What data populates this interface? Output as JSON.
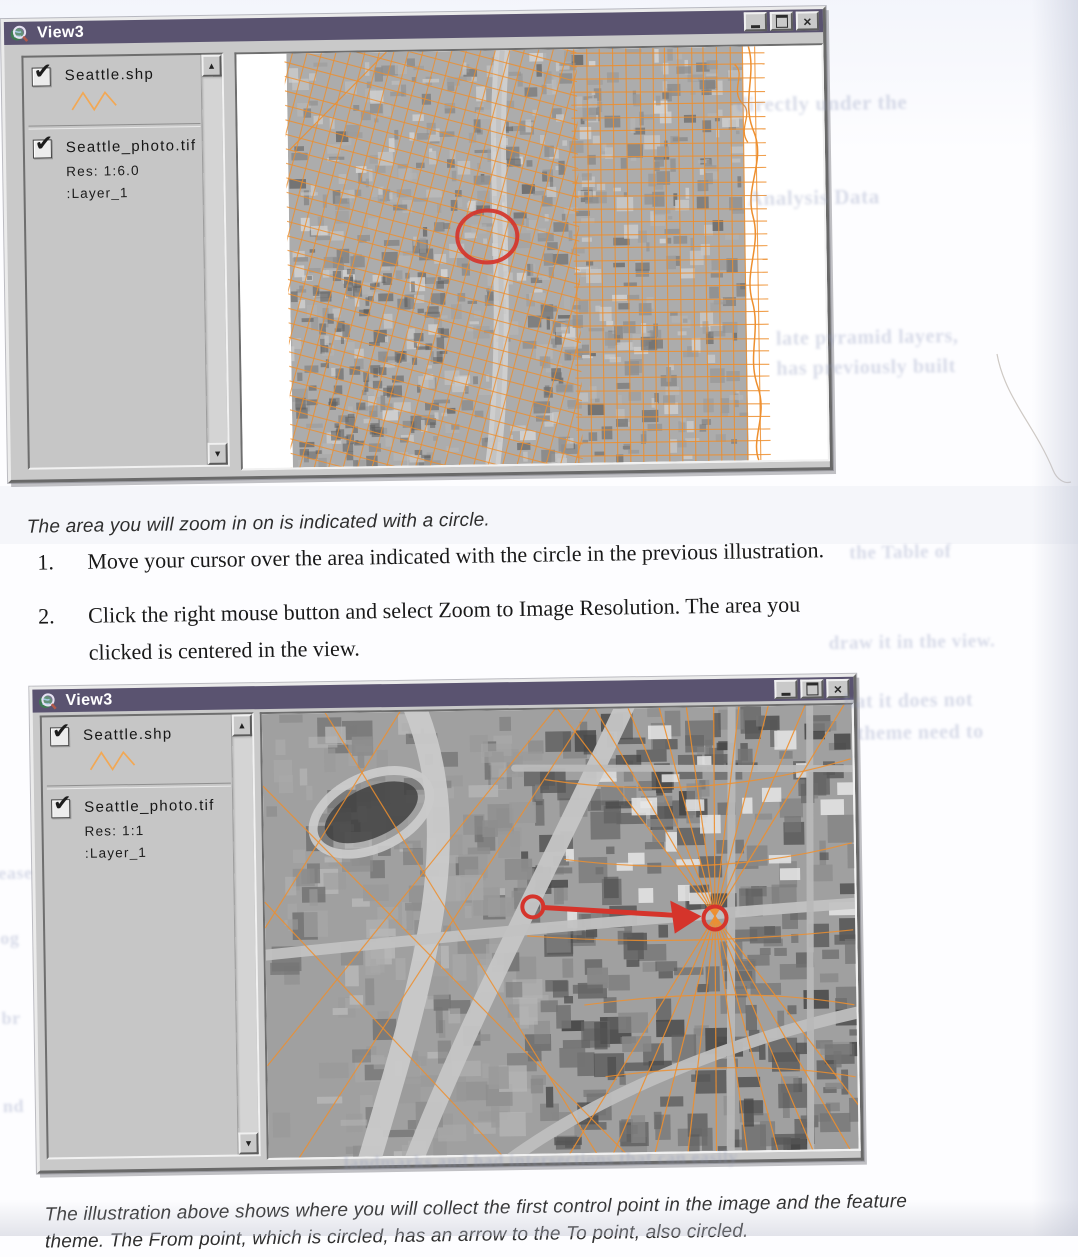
{
  "colors": {
    "titlebar": "#5a5370",
    "chrome": "#c9c9c9",
    "orange": "#ee8f2e",
    "orange_light": "#f2a854",
    "red": "#d5342b",
    "map_bg": "#ffffff"
  },
  "glyphs": {
    "check": "✔",
    "scroll_up": "▲",
    "scroll_down": "▼",
    "close": "×"
  },
  "caption_top": "The area you will zoom in on is indicated with a circle.",
  "steps": [
    {
      "num": "1.",
      "lines": [
        "Move your cursor over the area indicated with the circle in the previous illustration."
      ]
    },
    {
      "num": "2.",
      "lines": [
        "Click the right mouse button and select Zoom to Image Resolution. The area you",
        "clicked is centered in the view."
      ]
    }
  ],
  "caption_bottom": {
    "lines": [
      "The illustration above shows where you will collect the first control point in the image and the feature",
      "theme. The From point, which is circled, has an arrow to the To point, also circled."
    ]
  },
  "window_top": {
    "title": "View3",
    "legend": {
      "item1": {
        "label": "Seattle.shp",
        "checked": true,
        "symbol": "orange-zigzag-line"
      },
      "item2": {
        "label": "Seattle_photo.tif",
        "checked": true,
        "res": "Res: 1:6.0",
        "layer": ":Layer_1"
      }
    },
    "map": {
      "width": 585,
      "height": 414,
      "annotation_circle": {
        "cx": 248,
        "cy": 186,
        "rx": 30,
        "ry": 26
      }
    }
  },
  "window_bottom": {
    "title": "View3",
    "legend": {
      "item1": {
        "label": "Seattle.shp",
        "checked": true,
        "symbol": "orange-zigzag-line"
      },
      "item2": {
        "label": "Seattle_photo.tif",
        "checked": true,
        "res": "Res: 1:1",
        "layer": ":Layer_1"
      }
    },
    "map": {
      "width": 590,
      "height": 444,
      "from_circle": {
        "cx": 268,
        "cy": 197,
        "r": 10.5
      },
      "to_circle": {
        "cx": 450,
        "cy": 211,
        "r": 11.5
      },
      "arrow": {
        "x1": 280,
        "y1": 198,
        "x2": 414,
        "y2": 208
      }
    }
  },
  "ghost_fragments": [
    {
      "text": "directly under the",
      "x": 744,
      "y": 96,
      "fs": 21
    },
    {
      "text": "Analysis Data",
      "x": 754,
      "y": 190,
      "fs": 21
    },
    {
      "text": "late pyramid layers,",
      "x": 780,
      "y": 332,
      "fs": 20
    },
    {
      "text": "has previously built",
      "x": 780,
      "y": 362,
      "fs": 20
    },
    {
      "text": "the Table of",
      "x": 850,
      "y": 548,
      "fs": 19
    },
    {
      "text": "draw it in the view.",
      "x": 828,
      "y": 638,
      "fs": 19
    },
    {
      "text": "hat it does not",
      "x": 842,
      "y": 696,
      "fs": 20
    },
    {
      "text": "theme need to",
      "x": 855,
      "y": 728,
      "fs": 20
    },
    {
      "text": "ease",
      "x": -6,
      "y": 855,
      "fs": 18
    },
    {
      "text": "og",
      "x": -5,
      "y": 920,
      "fs": 18
    },
    {
      "text": "br",
      "x": -5,
      "y": 1000,
      "fs": 18
    },
    {
      "text": "nd",
      "x": -5,
      "y": 1088,
      "fs": 18
    },
    {
      "text": "landmarks and had intersections that can easily",
      "x": 335,
      "y": 1150,
      "fs": 18
    }
  ]
}
